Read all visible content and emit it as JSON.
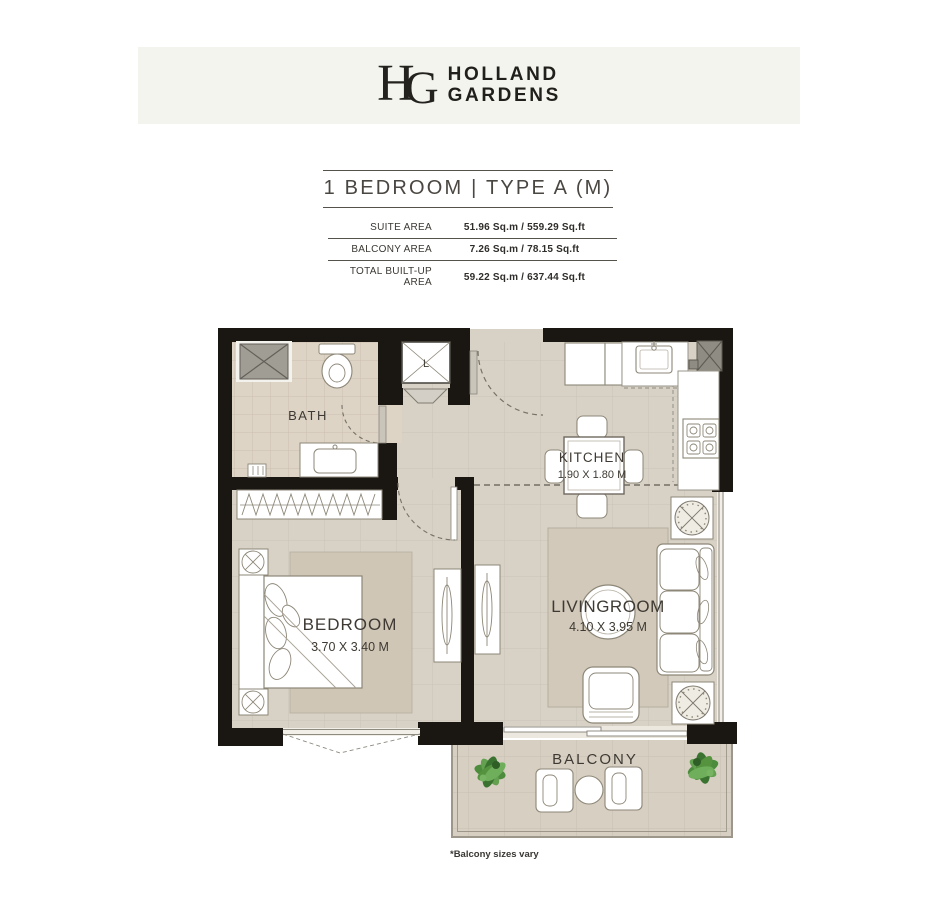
{
  "brand": {
    "monogram": {
      "h": "H",
      "g": "G"
    },
    "name_line1": "HOLLAND",
    "name_line2": "GARDENS"
  },
  "unit": {
    "title": "1 BEDROOM  |  TYPE A (M)"
  },
  "area_table": {
    "rows": [
      {
        "label": "SUITE AREA",
        "value": "51.96 Sq.m / 559.29 Sq.ft"
      },
      {
        "label": "BALCONY AREA",
        "value": "7.26 Sq.m / 78.15 Sq.ft"
      },
      {
        "label": "TOTAL BUILT-UP AREA",
        "value": "59.22 Sq.m / 637.44 Sq.ft"
      }
    ]
  },
  "plan": {
    "rooms": {
      "bath": {
        "name": "BATH"
      },
      "kitchen": {
        "name": "KITCHEN",
        "dims": "1.90 X 1.80 M"
      },
      "living": {
        "name": "LIVINGROOM",
        "dims": "4.10 X 3.95 M"
      },
      "bedroom": {
        "name": "BEDROOM",
        "dims": "3.70 X 3.40 M"
      },
      "balcony": {
        "name": "BALCONY"
      }
    },
    "elevator_label": "L",
    "footnote": "*Balcony sizes vary"
  },
  "colors": {
    "header_band": "#f4f4ef",
    "wall": "#1a1713",
    "floor": "#d8d1c5",
    "bath_floor": "#ddd4c6",
    "bedroom_rug": "#cfc6b6",
    "living_rug": "#d2c9ba",
    "balcony_floor": "#d6cfc2",
    "furniture_stroke": "#8d8778",
    "shaft_gray": "#a09d94",
    "plant_green": "#4c8c3c",
    "label_text": "#3e3a33"
  }
}
